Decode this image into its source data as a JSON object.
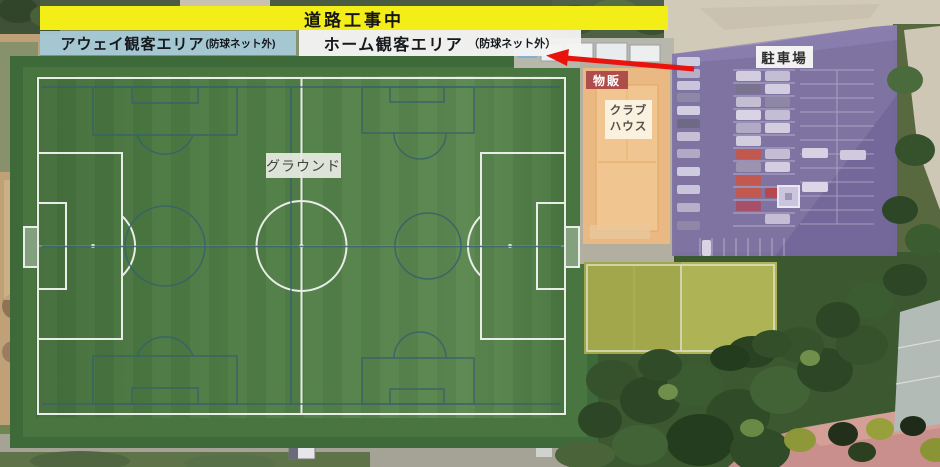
{
  "map": {
    "banners": {
      "construction": "道路工事中",
      "away_area": {
        "label": "アウェイ観客エリア",
        "note": "(防球ネット外)"
      },
      "home_area": {
        "label": "ホーム観客エリア",
        "note": "（防球ネット外）"
      }
    },
    "areas": {
      "ground": "グラウンド",
      "merchandise": "物販",
      "clubhouse_line1": "クラブ",
      "clubhouse_line2": "ハウス",
      "parking": "駐車場"
    },
    "colors": {
      "construction_banner": "#f3ee18",
      "away_banner": "#a7c9d5",
      "home_banner": "#f4f4f2",
      "merch_badge": "#ae4d49",
      "clubhouse_overlay": "#f0b97f",
      "parking_overlay": "#7e72a4",
      "practice_field": "#9aa04b",
      "pitch_green": "#538049",
      "arrow": "#ea120c"
    }
  }
}
